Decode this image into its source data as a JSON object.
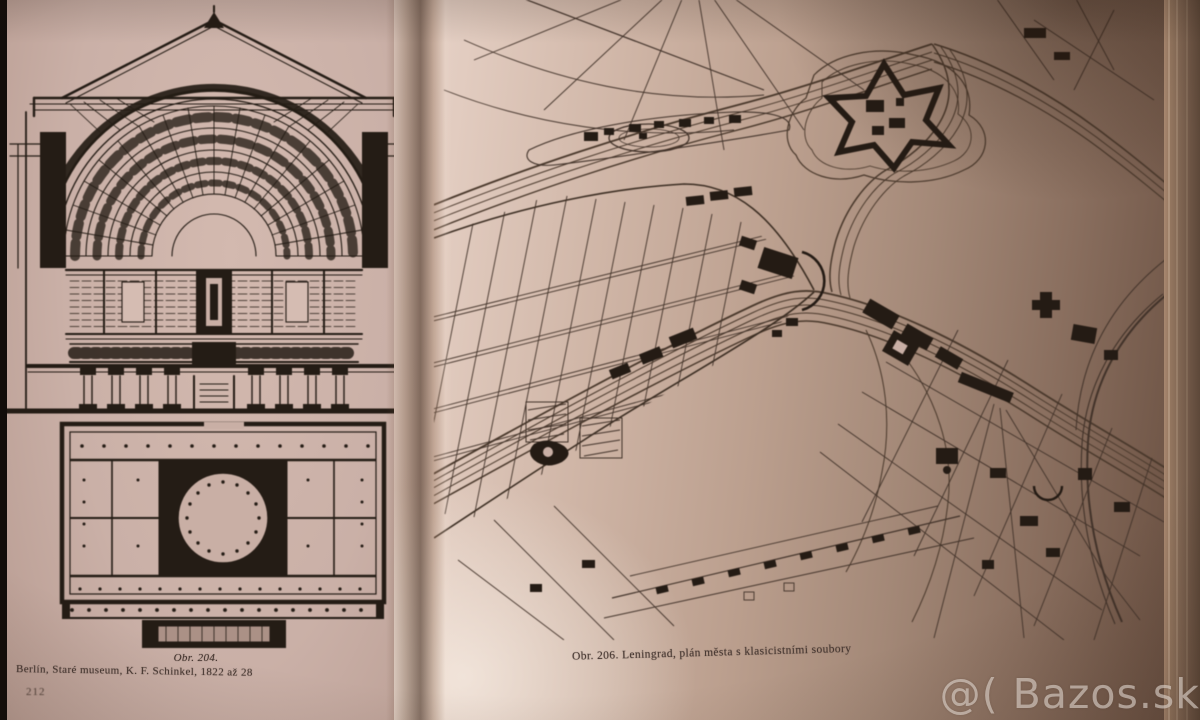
{
  "left_page": {
    "page_number": "212",
    "caption_line1": "Obr. 204.",
    "caption_line2": "Berlín, Staré museum, K. F. Schinkel, 1822 až 28"
  },
  "right_page": {
    "caption": "Obr. 206. Leningrad, plán města s klasicistními soubory"
  },
  "watermark": {
    "text": "@( Bazos.sk"
  },
  "figures": {
    "dome_section": "dome-section-figure",
    "floor_plan": "floor-plan-figure",
    "city_plan": "city-plan-figure"
  },
  "colors": {
    "page_light": "#d3b9af",
    "page_dark": "#6a5143",
    "ink": "#241c15",
    "map_ink": "#42332a",
    "gutter_shadow": "#463020",
    "watermark": "rgba(238,230,222,0.55)"
  }
}
